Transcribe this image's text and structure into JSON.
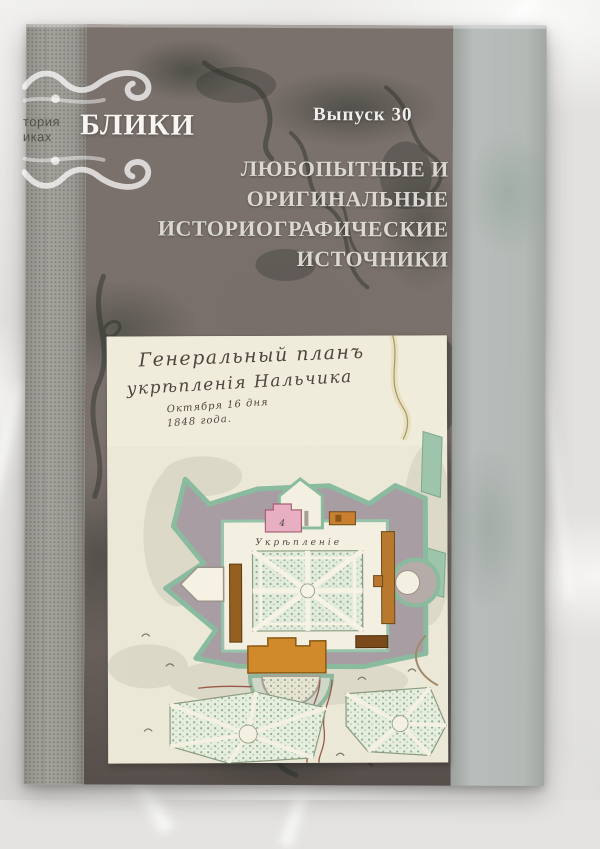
{
  "scene": {
    "description": "Photograph of a grey marbled book cover lying on white plastic wrap"
  },
  "book": {
    "spine": {
      "series_fragment_line1": "тория",
      "series_fragment_line2": "иках"
    },
    "cover": {
      "logo": "БЛИКИ",
      "issue_label": "Выпуск 30",
      "title_lines": [
        "ЛЮБОПЫТНЫЕ И",
        "ОРИГИНАЛЬНЫЕ",
        "ИСТОРИОГРАФИЧЕСКИЕ",
        "ИСТОЧНИКИ"
      ]
    },
    "map_plate": {
      "title_line1": "Генеральный планъ",
      "title_line2": "укрѣпленія Нальчика",
      "date_line1": "Октября 16 дня",
      "date_line2": "1848 года.",
      "fort_label": "Укрѣпленіе",
      "building_number": "4"
    },
    "colors": {
      "cover_base": "#7b716c",
      "cover_marble_dark": "#343b33",
      "spine_strip": "#c8c7c3",
      "fore_edge_strip": "#b1b6b4",
      "logo_text": "#f7f6f3",
      "title_text": "#dbd8d3",
      "map_paper": "#ece8d7",
      "map_rampart_green": "#8abb9f",
      "map_rampart_fill": "#a89da2",
      "map_garden_green": "#e3ecdc",
      "map_pink_building": "#e8afc2",
      "map_orange_building": "#c88030"
    }
  }
}
